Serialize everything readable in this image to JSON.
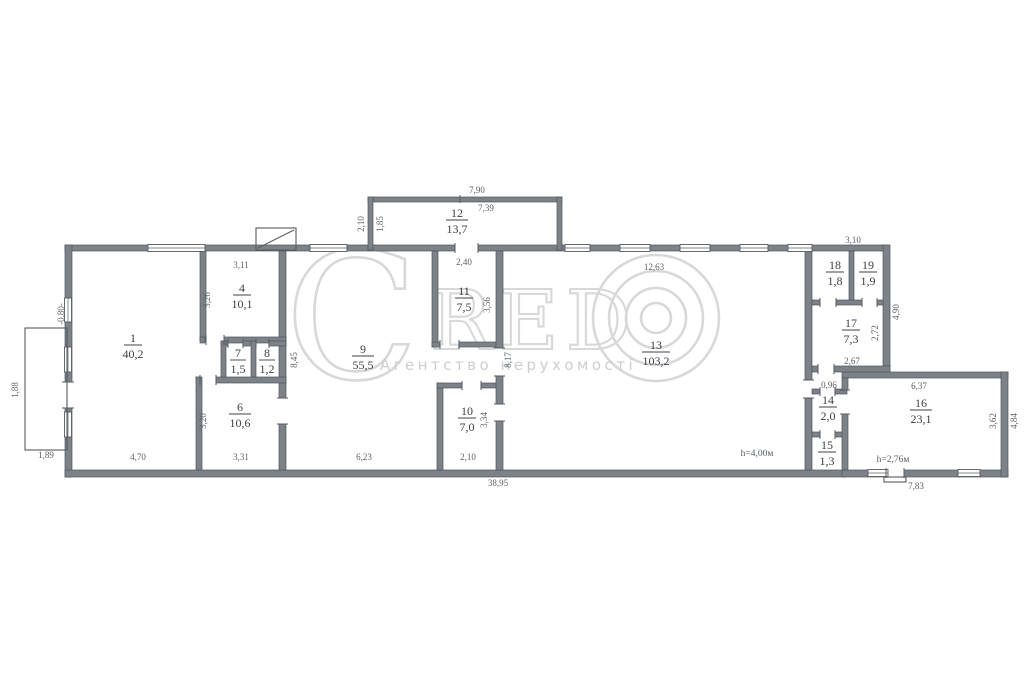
{
  "watermark": {
    "c": "C",
    "red": "RED",
    "copyright_symbol": "©",
    "tagline": "Агентство нерухомості"
  },
  "rooms": [
    {
      "no": "1",
      "area": "40,2"
    },
    {
      "no": "4",
      "area": "10,1"
    },
    {
      "no": "7",
      "area": "1,5"
    },
    {
      "no": "8",
      "area": "1,2"
    },
    {
      "no": "6",
      "area": "10,6"
    },
    {
      "no": "9",
      "area": "55,5"
    },
    {
      "no": "11",
      "area": "7,5"
    },
    {
      "no": "10",
      "area": "7,0"
    },
    {
      "no": "12",
      "area": "13,7"
    },
    {
      "no": "13",
      "area": "103,2"
    },
    {
      "no": "18",
      "area": "1,8"
    },
    {
      "no": "19",
      "area": "1,9"
    },
    {
      "no": "17",
      "area": "7,3"
    },
    {
      "no": "14",
      "area": "2,0"
    },
    {
      "no": "15",
      "area": "1,3"
    },
    {
      "no": "16",
      "area": "23,1"
    }
  ],
  "dims_h": [
    "7,90",
    "7,39",
    "3,11",
    "2,40",
    "12,63",
    "3,10",
    "2,67",
    "0,96",
    "6,37",
    "4,70",
    "3,31",
    "6,23",
    "2,10",
    "1,89",
    "38,95",
    "7,83"
  ],
  "dims_v": [
    "2,10",
    "1,85",
    "3,26",
    "3,56",
    "8,45",
    "8,17",
    "4,90",
    "2,72",
    "3,62",
    "4,84",
    "3,20",
    "3,34",
    "1,88",
    "-0,80-"
  ],
  "heights": {
    "room13": "h=4,00м",
    "room16": "h=2,76м"
  }
}
